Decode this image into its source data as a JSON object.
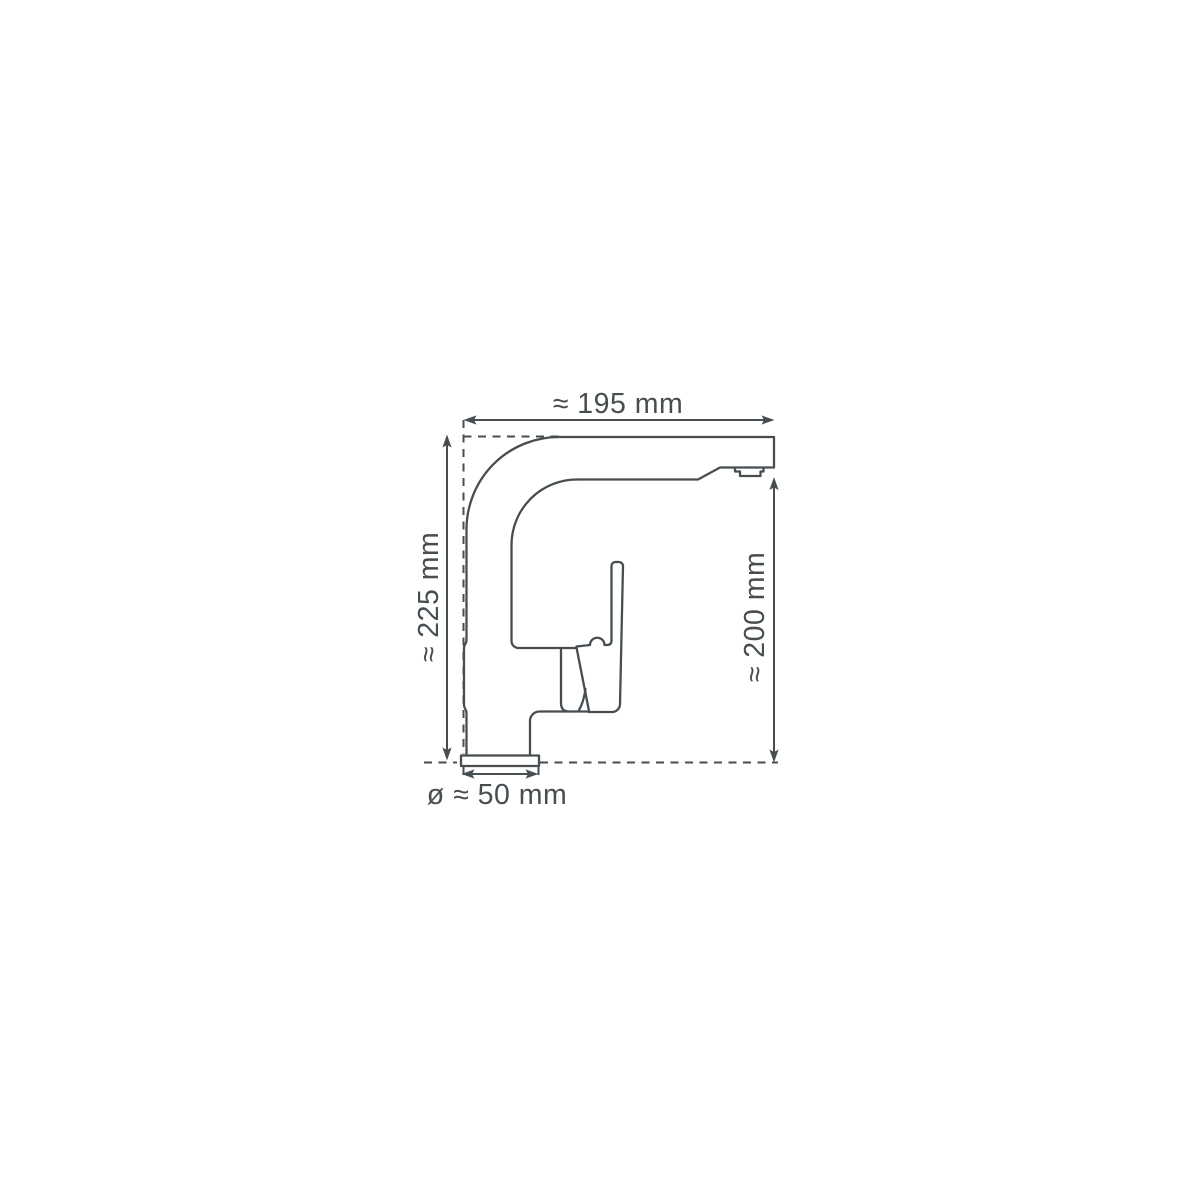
{
  "labels": {
    "spout_reach": "≈ 195 mm",
    "total_height": "≈ 225 mm",
    "spout_height": "≈ 200 mm",
    "base_diameter": "ø ≈ 50 mm"
  },
  "colors": {
    "line": "#474e52",
    "background": "#ffffff"
  }
}
